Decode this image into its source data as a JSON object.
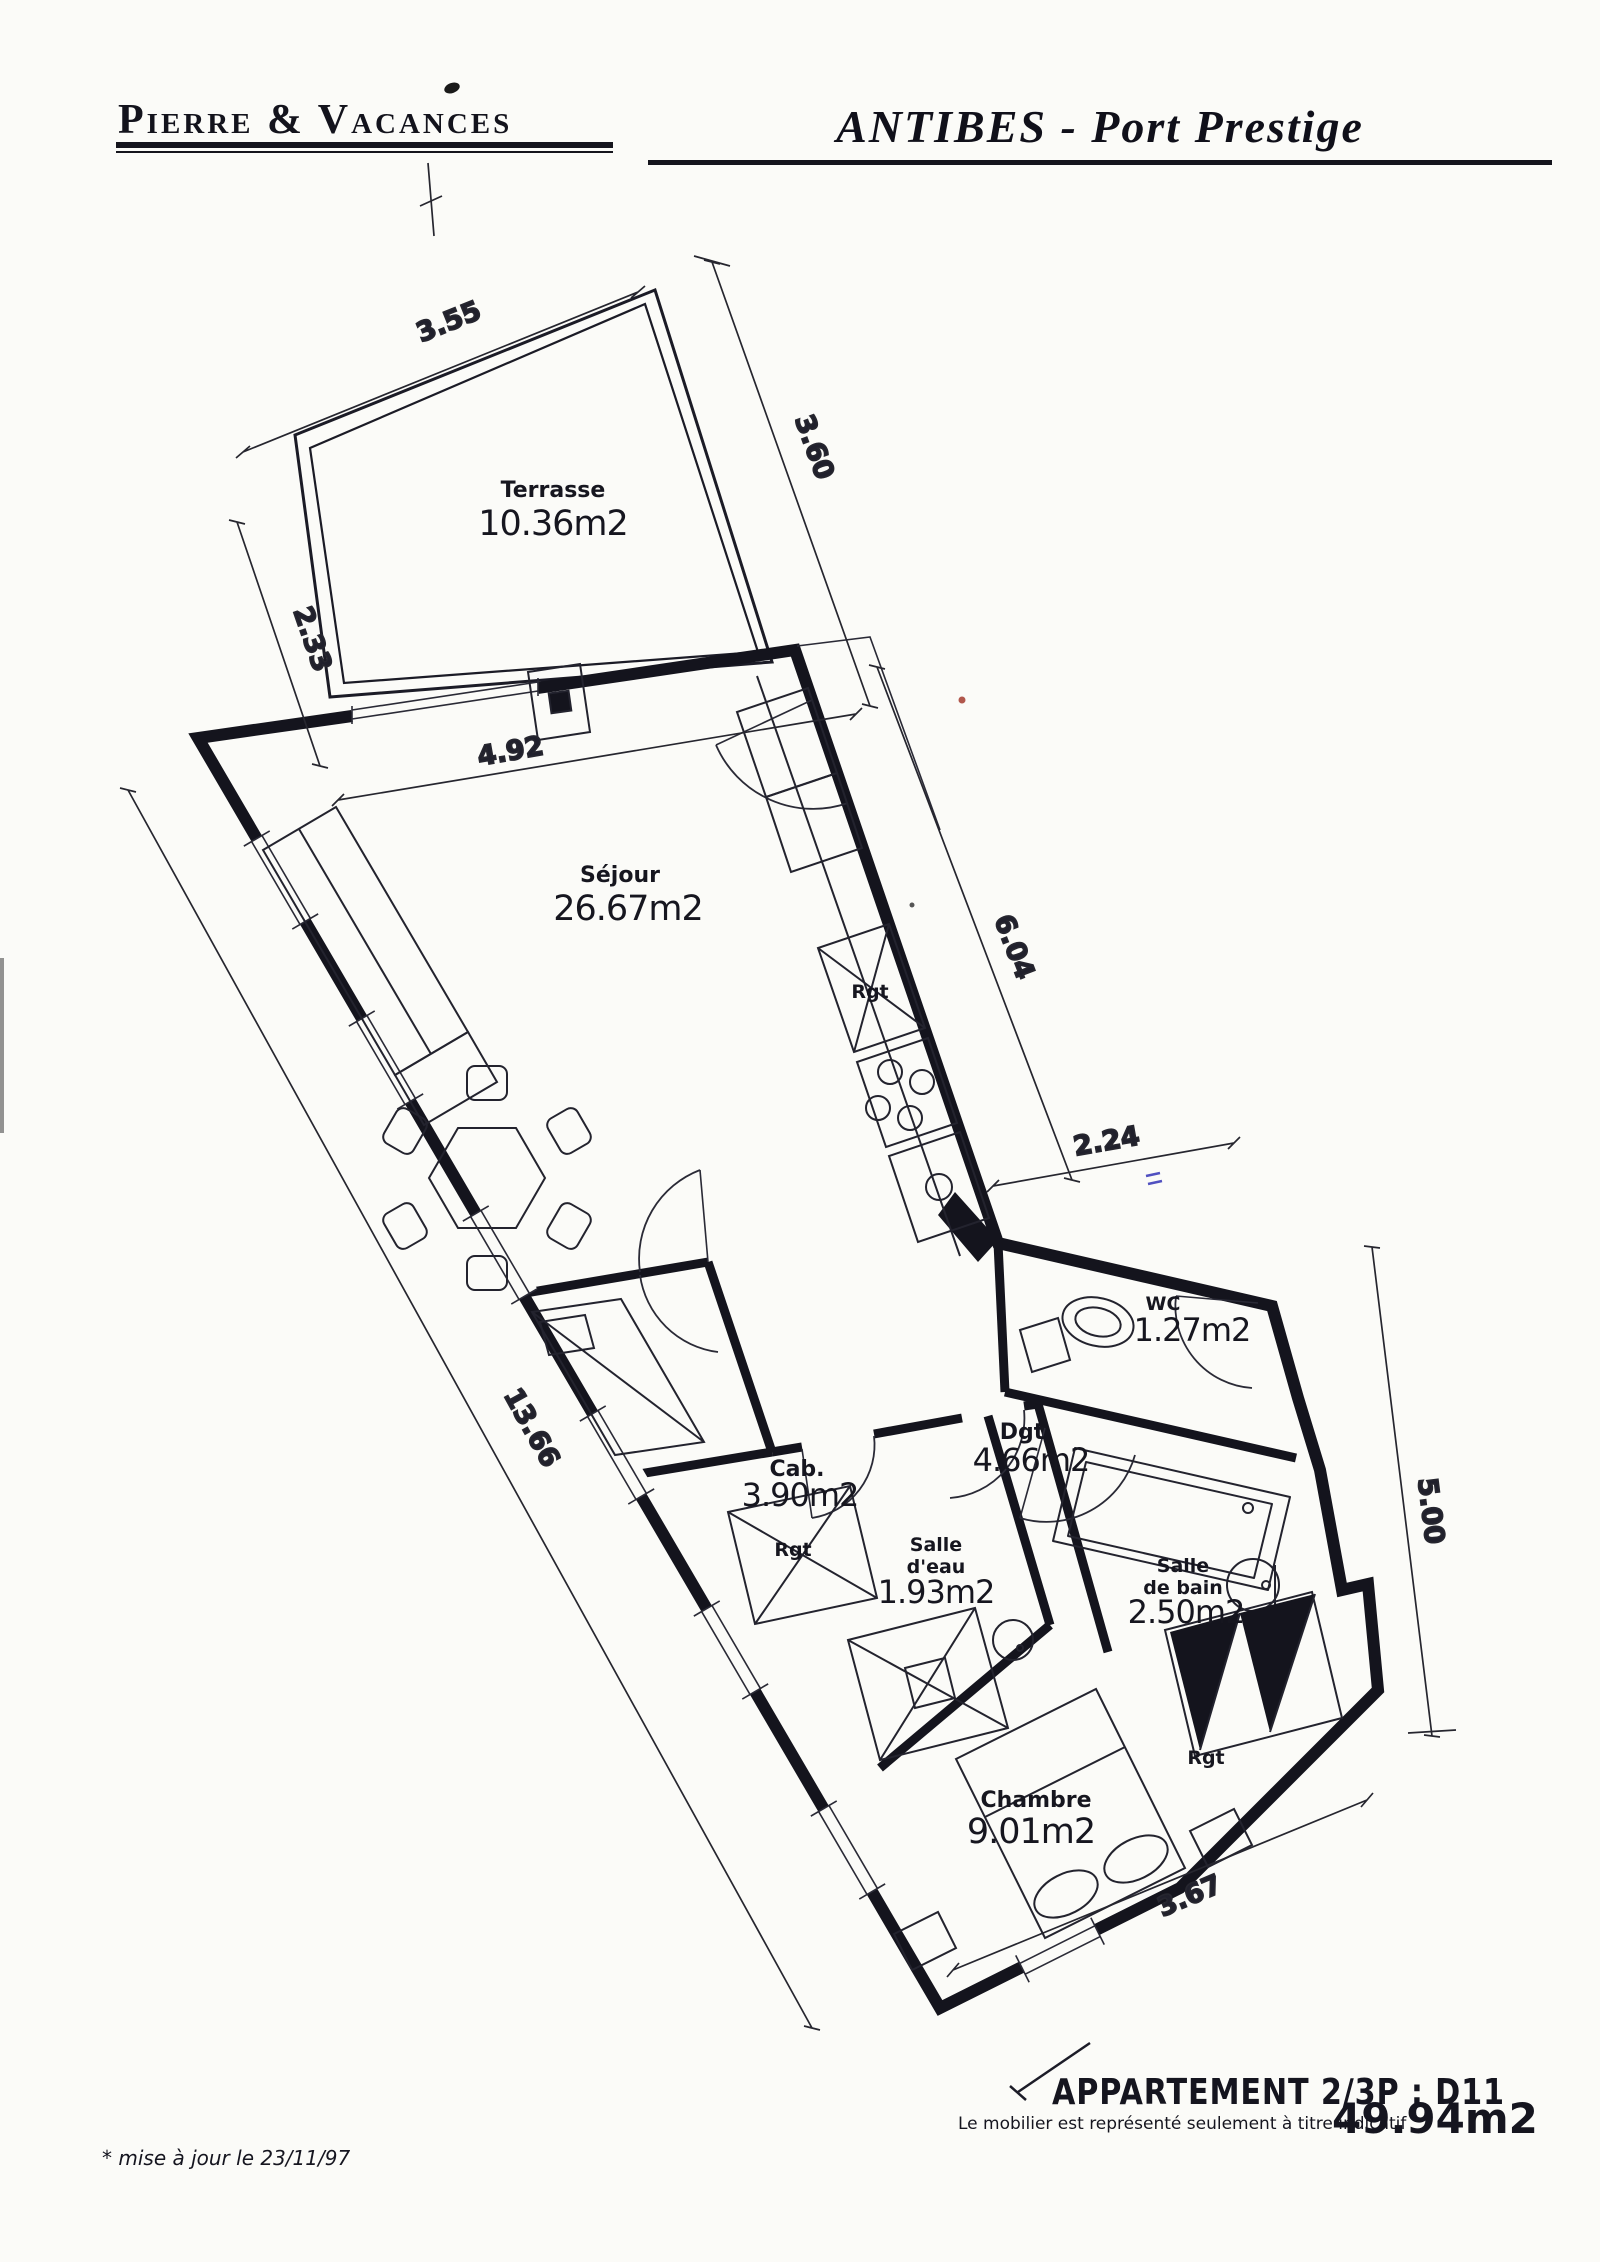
{
  "header": {
    "company": "Pierre & Vacances",
    "project": "ANTIBES - Port Prestige"
  },
  "rooms": {
    "terrasse": {
      "name": "Terrasse",
      "area": "10.36m2"
    },
    "sejour": {
      "name": "Séjour",
      "area": "26.67m2"
    },
    "wc": {
      "name": "WC",
      "area": "1.27m2"
    },
    "degagement": {
      "name": "Dgt",
      "area": "4.66m2"
    },
    "cabine": {
      "name": "Cab.",
      "area": "3.90m2"
    },
    "salle_eau": {
      "name_line1": "Salle",
      "name_line2": "d'eau",
      "area": "1.93m2"
    },
    "salle_de_bain": {
      "name_line1": "Salle",
      "name_line2": "de bain",
      "area": "2.50m2"
    },
    "chambre": {
      "name": "Chambre",
      "area": "9.01m2"
    }
  },
  "storage_label": "Rgt",
  "dimensions": {
    "terrace_top": "3.55",
    "terrace_right": "3.60",
    "terrace_left": "2.33",
    "sejour_width": "4.92",
    "kitchen_wall": "6.04",
    "wc_width": "2.24",
    "left_wall": "13.66",
    "right_height": "5.00",
    "chambre_width": "3.67"
  },
  "footer": {
    "apartment_title": "APPARTEMENT 2/3P : D11",
    "furniture_note": "Le mobilier est représenté seulement à titre indicatif",
    "total_area": "49.94m2",
    "revision_note": "* mise à jour le 23/11/97"
  }
}
